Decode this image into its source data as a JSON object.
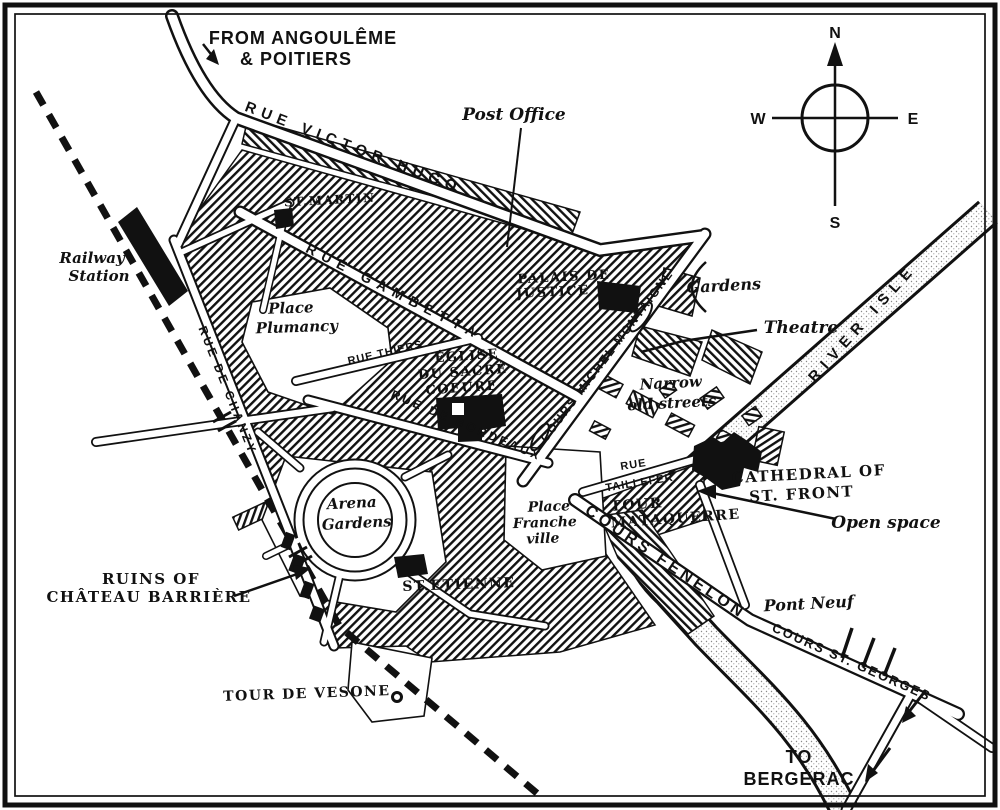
{
  "map": {
    "labels": {
      "from_1": "FROM ANGOULÊME",
      "from_2": "& POITIERS",
      "to_1": "TO",
      "to_2": "BERGERAC",
      "compass_n": "N",
      "compass_s": "S",
      "compass_e": "E",
      "compass_w": "W",
      "rue_victor_hugo": "RUE VICTOR HUGO",
      "rue_gambetta": "RUE GAMBETTA",
      "rue_thiers": "RUE THIERS",
      "rue_de_chanzy": "RUE DE CHANZY",
      "rue_de_bordeaux": "RUE DE BORDEAUX",
      "cours_michel_montaigne": "COURS MICHEL MONTAIGNE",
      "rue_taillefer_1": "RUE",
      "rue_taillefer_2": "TAILLEFER",
      "cours_fenelon": "COURS FENELON",
      "cours_st_georges": "COURS ST. GEORGES",
      "river_isle": "RIVER ISLE",
      "pont_neuf": "Pont Neuf",
      "post_office": "Post Office",
      "railway_station_1": "Railway",
      "railway_station_2": "Station",
      "st_martin": "ST.MARTIN",
      "place_plumancy_1": "Place",
      "place_plumancy_2": "Plumancy",
      "palais_de_justice_1": "PALAIS DE",
      "palais_de_justice_2": "JUSTICE",
      "gardens": "Gardens",
      "theatre": "Theatre",
      "eglise_1": "ÉGLISE",
      "eglise_2": "DU SACRÉ",
      "eglise_3": "COEURE",
      "narrow_old_streets_1": "Narrow",
      "narrow_old_streets_2": "old streets",
      "cathedral_1": "CATHEDRAL OF",
      "cathedral_2": "ST. FRONT",
      "open_space": "Open space",
      "tour_mataquerre_1": "TOUR",
      "tour_mataquerre_2": "MATAQUERRE",
      "place_francheville_1": "Place",
      "place_francheville_2": "Franche",
      "place_francheville_3": "ville",
      "arena_gardens_1": "Arena",
      "arena_gardens_2": "Gardens",
      "st_etienne": "ST.ETIENNE",
      "ruins_1": "RUINS OF",
      "ruins_2": "CHÂTEAU BARRIÈRE",
      "tour_de_vesone": "TOUR DE VESONE"
    },
    "colors": {
      "ink": "#111111",
      "paper": "#ffffff",
      "stipple": "#8a8a8a"
    }
  }
}
